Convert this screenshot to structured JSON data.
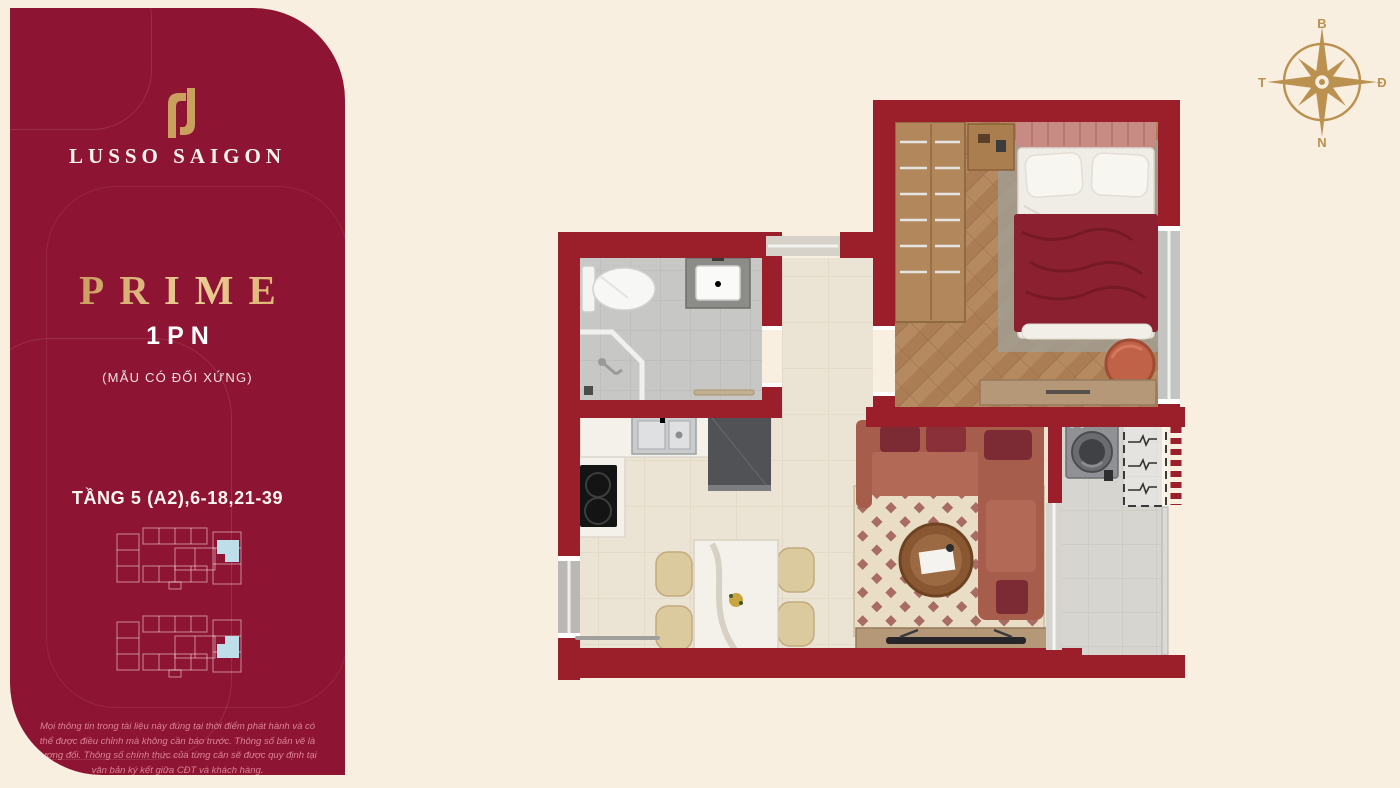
{
  "background_color": "#f9efe1",
  "sidebar": {
    "panel_color": "#8d1432",
    "logo": {
      "brand": "LUSSO SAIGON",
      "mark_color": "#c9a05e"
    },
    "plan_name": "PRIME",
    "plan_type": "1PN",
    "plan_note": "(MẪU CÓ ĐỐI XỨNG)",
    "floors_label": "TẦNG 5 (A2),6-18,21-39",
    "keyplan": {
      "outline_color": "rgba(255,255,255,0.5)",
      "highlight_color": "#bedfe9",
      "floors_shown": 2
    },
    "disclaimer": "Mọi thông tin trong tài liệu này đúng tại thời điểm phát hành và có thể được điều chỉnh mà không cần báo trước. Thông số bản vẽ là tương đối. Thông số chính thức của từng căn sẽ được quy định tại văn bản ký kết giữa CĐT và khách hàng."
  },
  "compass": {
    "north": "B",
    "east": "Đ",
    "south": "N",
    "west": "T",
    "color": "#bb9150"
  },
  "floorplan": {
    "wall_color": "#9b1f2a",
    "rooms": [
      "bathroom",
      "hallway",
      "kitchen",
      "dining",
      "living-room",
      "bedroom",
      "balcony",
      "technical-shaft"
    ],
    "floor_colors": {
      "bathroom": "#c7c7c5",
      "kitchen_living": "#ebe3d3",
      "bedroom_wood": "#b68a60",
      "balcony": "#d7d5cf"
    }
  }
}
